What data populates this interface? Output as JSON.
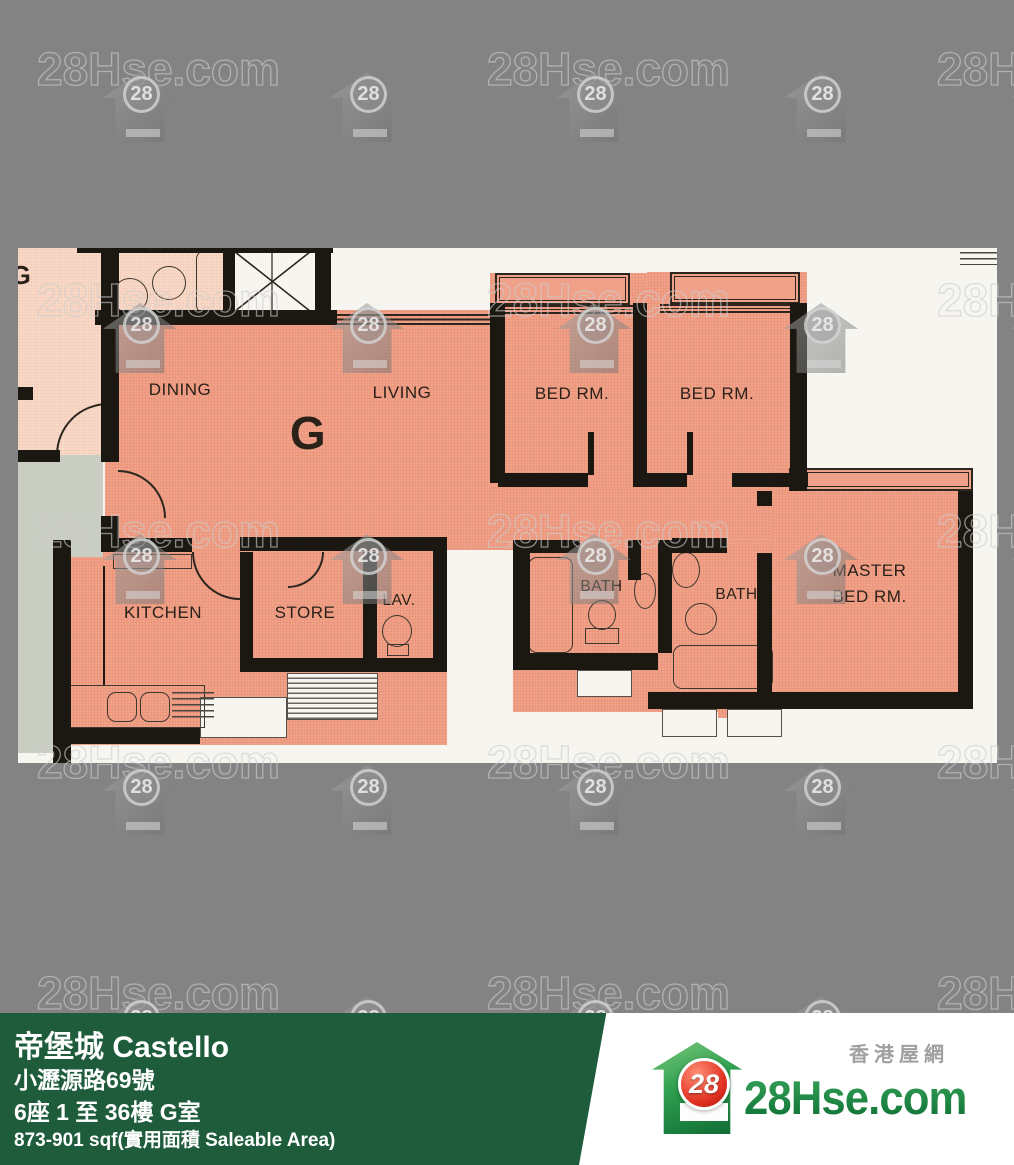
{
  "watermark": {
    "text": "28Hse.com",
    "badge": "28"
  },
  "plan": {
    "unit_label": "G",
    "adjacent": {
      "unit_label": "G",
      "bath_label": "BATH"
    },
    "rooms": {
      "dining": "DINING",
      "living": "LIVING",
      "bed1": "BED RM.",
      "bed2": "BED RM.",
      "master_line1": "MASTER",
      "master_line2": "BED RM.",
      "kitchen": "KITCHEN",
      "store": "STORE",
      "lav": "LAV.",
      "bath1": "BATH",
      "bath2": "BATH"
    }
  },
  "banner": {
    "title": "帝堡城 Castello",
    "address": "小瀝源路69號",
    "floors": "6座 1 至 36樓 G室",
    "area": "873-901 sqf(實用面積 Saleable Area)"
  },
  "logo": {
    "site_zh": "香港屋網",
    "site": "28Hse.com",
    "badge": "28"
  },
  "colors": {
    "background": "#838383",
    "unit_fill": "#efa189",
    "adjacent_fill": "#f8d9c8",
    "banner_green": "#1e5c3c",
    "logo_green": "#1f8c4c",
    "logo_red": "#dd3526"
  }
}
